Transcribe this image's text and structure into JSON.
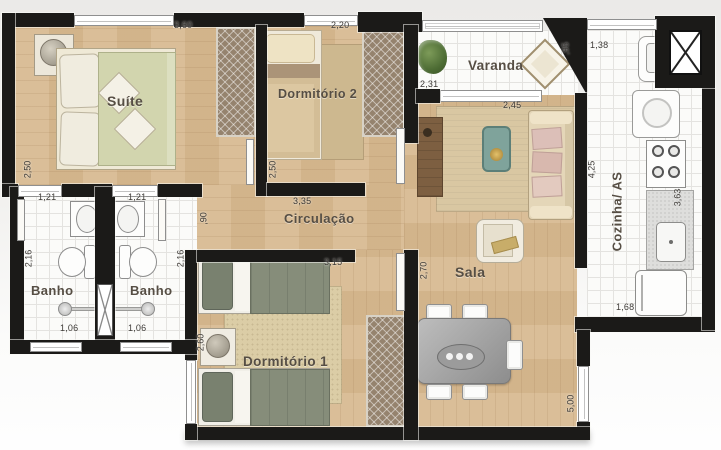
{
  "plan": {
    "rooms": {
      "suite": "Suíte",
      "dormitorio2": "Dormitório 2",
      "varanda": "Varanda",
      "cozinha": "Cozinha/ AS",
      "sala": "Sala",
      "circulacao": "Circulação",
      "banho_left": "Banho",
      "banho_right": "Banho",
      "dormitorio1": "Dormitório 1"
    },
    "dimensions": {
      "suite_width": "3,60",
      "dorm2_width": "2,20",
      "suite_depth": "2,50",
      "dorm2_depth": "2,50",
      "banho_left_door": "1,21",
      "banho_right_door": "1,21",
      "banho_left_depth": "2,16",
      "banho_right_depth": "2,16",
      "banho_left_window": "1,06",
      "banho_right_window": "1,06",
      "corridor_depth": ",90",
      "corridor_width": "3,35",
      "dorm1_width": "3,15",
      "dorm1_depth": "2,60",
      "varanda_width": "2,31",
      "varanda_depth": ",95",
      "sala_width": "2,45",
      "sala_depth": "2,70",
      "sala_length": "5,00",
      "kitchen_window": "1,38",
      "kitchen_depth": "4,25",
      "kitchen_counter": "3,63",
      "kitchen_width": "1,68"
    },
    "icons": {
      "double-bed": "css-rect",
      "single-bed": "css-rect",
      "wardrobe": "css-hatch",
      "nightstand-lamp": "css-circle",
      "toilet": "css-oval",
      "bathroom-sink": "css-oval",
      "shower": "css-circle-arm",
      "shaft-x": "svg-x-cross",
      "plant": "css-blob",
      "diamond-table": "css-diamond",
      "sofa": "css-rect",
      "armchair": "css-rect",
      "coffee-table": "css-rect",
      "tv-cabinet": "css-rect",
      "dining-table": "css-rect",
      "dining-chair": "css-rect",
      "kitchen-sink": "css-square",
      "washer": "css-square-circle",
      "stove": "css-burners",
      "counter-sink": "css-square",
      "fridge": "css-rect",
      "door-leaf": "css-rect",
      "window": "css-rect"
    },
    "colors": {
      "wall": "#1b1a18",
      "wood_floor": "#d7b990",
      "tile_floor": "#fbfbf9",
      "suite_bed": "#d2d5ae",
      "dorm1_bed": "#868d7a",
      "rug": "#d9c7a2",
      "coffee_table_teal": "#7fa39b"
    }
  }
}
